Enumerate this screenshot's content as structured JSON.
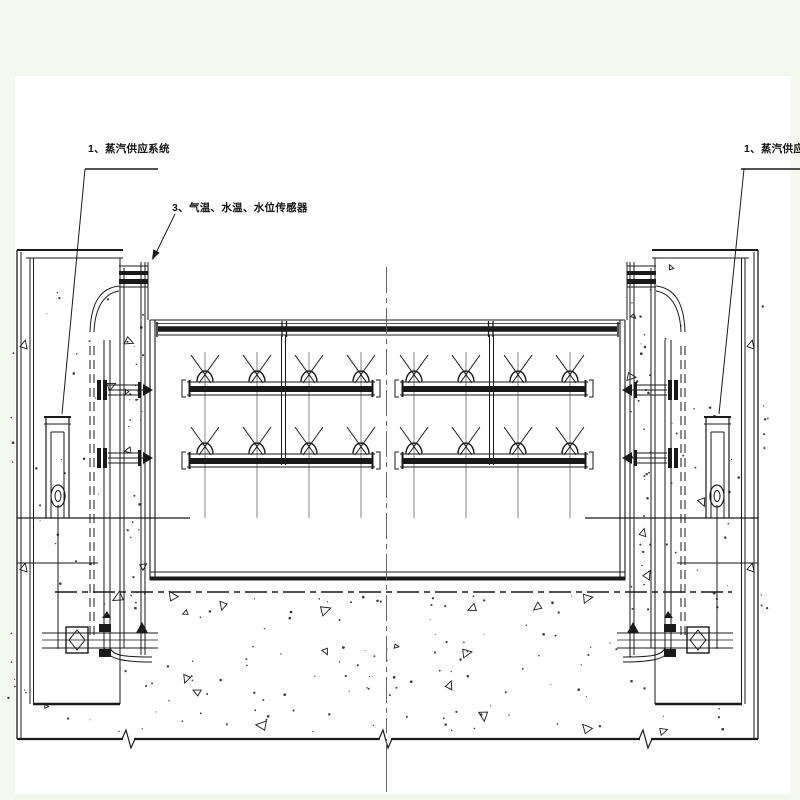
{
  "colors": {
    "paper": "#ffffff",
    "margin": "#f4f8ee",
    "ink": "#1a1a1a",
    "thin_line": "#666666"
  },
  "labels": {
    "steam_supply_left": "1、蒸汽供应系统",
    "sensors": "3、气温、水温、水位传感器",
    "steam_supply_right": "1、蒸汽供应系统"
  },
  "diagram": {
    "type": "technical-drawing",
    "spray_pipe_rows": 2,
    "halves": 2,
    "spray_nozzle_columns_per_half": 4,
    "valve_count": 2,
    "cylinder_count": 2
  }
}
